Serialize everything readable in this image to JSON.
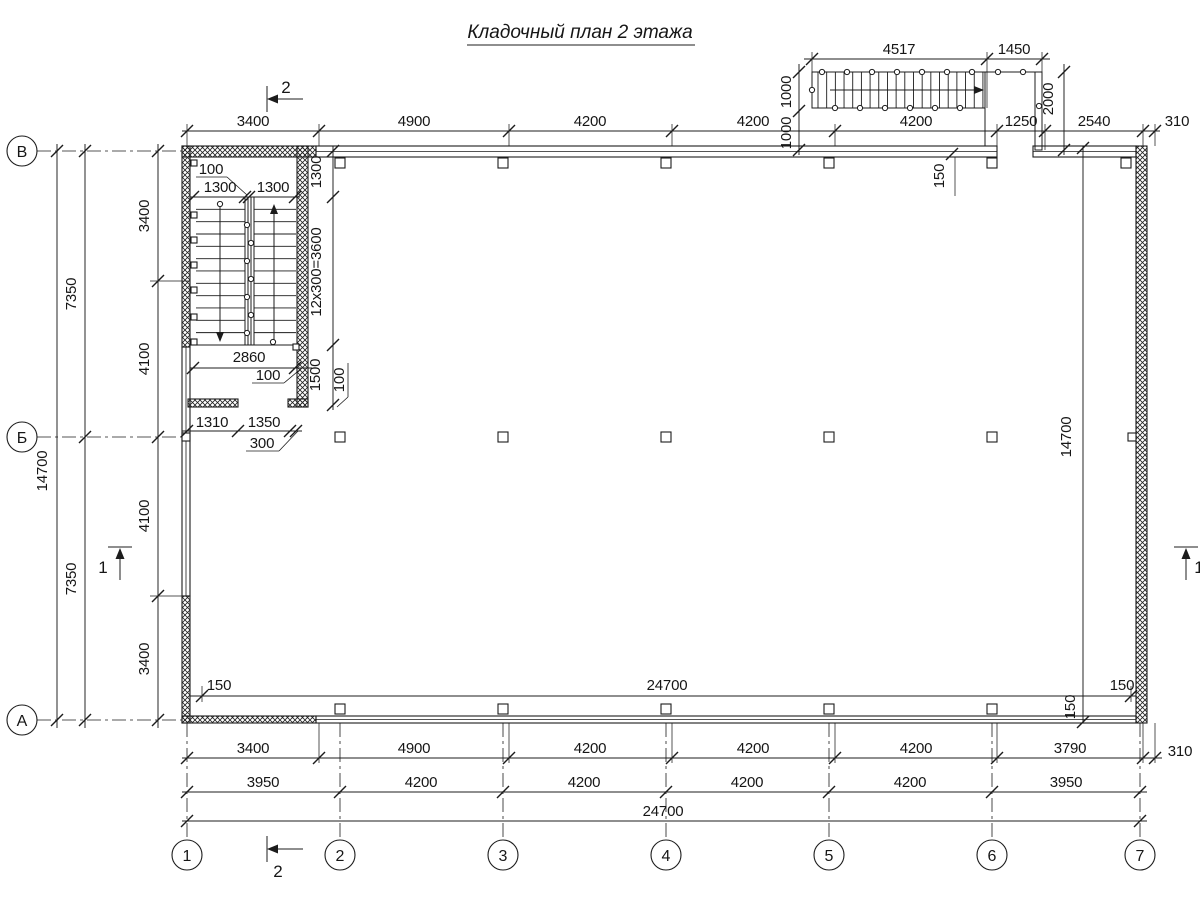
{
  "title": "Кладочный план 2 этажа",
  "axes": {
    "left": [
      "В",
      "Б",
      "А"
    ],
    "bottom": [
      "1",
      "2",
      "3",
      "4",
      "5",
      "6",
      "7"
    ]
  },
  "dims": {
    "top_row": [
      "3400",
      "4900",
      "4200",
      "4200",
      "4200",
      "1250",
      "2540",
      "310"
    ],
    "ext_stair": {
      "w1": "4517",
      "w2": "1450",
      "ha": "1000",
      "hb": "1000",
      "hc": "2000",
      "off": "150"
    },
    "left": {
      "inner": [
        "3400",
        "4100",
        "4100",
        "3400"
      ],
      "mid": [
        "7350",
        "7350"
      ],
      "outer": "14700"
    },
    "stair": {
      "n100a": "100",
      "f1": "1300",
      "f2": "1300",
      "land": "1300",
      "run": "12x300=3600",
      "w": "2860",
      "n100b": "100",
      "h": "1500",
      "n100c": "100",
      "a": "1310",
      "b": "1350",
      "n300": "300"
    },
    "interior": {
      "l": "150",
      "span": "24700",
      "r": "150",
      "vspan": "14700",
      "t": "150",
      "bo": "150"
    },
    "bottom_row1": [
      "3400",
      "4900",
      "4200",
      "4200",
      "4200",
      "3790",
      "310"
    ],
    "bottom_row2": [
      "3950",
      "4200",
      "4200",
      "4200",
      "4200",
      "3950"
    ],
    "total": "24700"
  },
  "markers": {
    "s1": "1",
    "s2": "2"
  },
  "colors": {
    "ink": "#1c1c1c",
    "rail": "#9b9b9b"
  }
}
